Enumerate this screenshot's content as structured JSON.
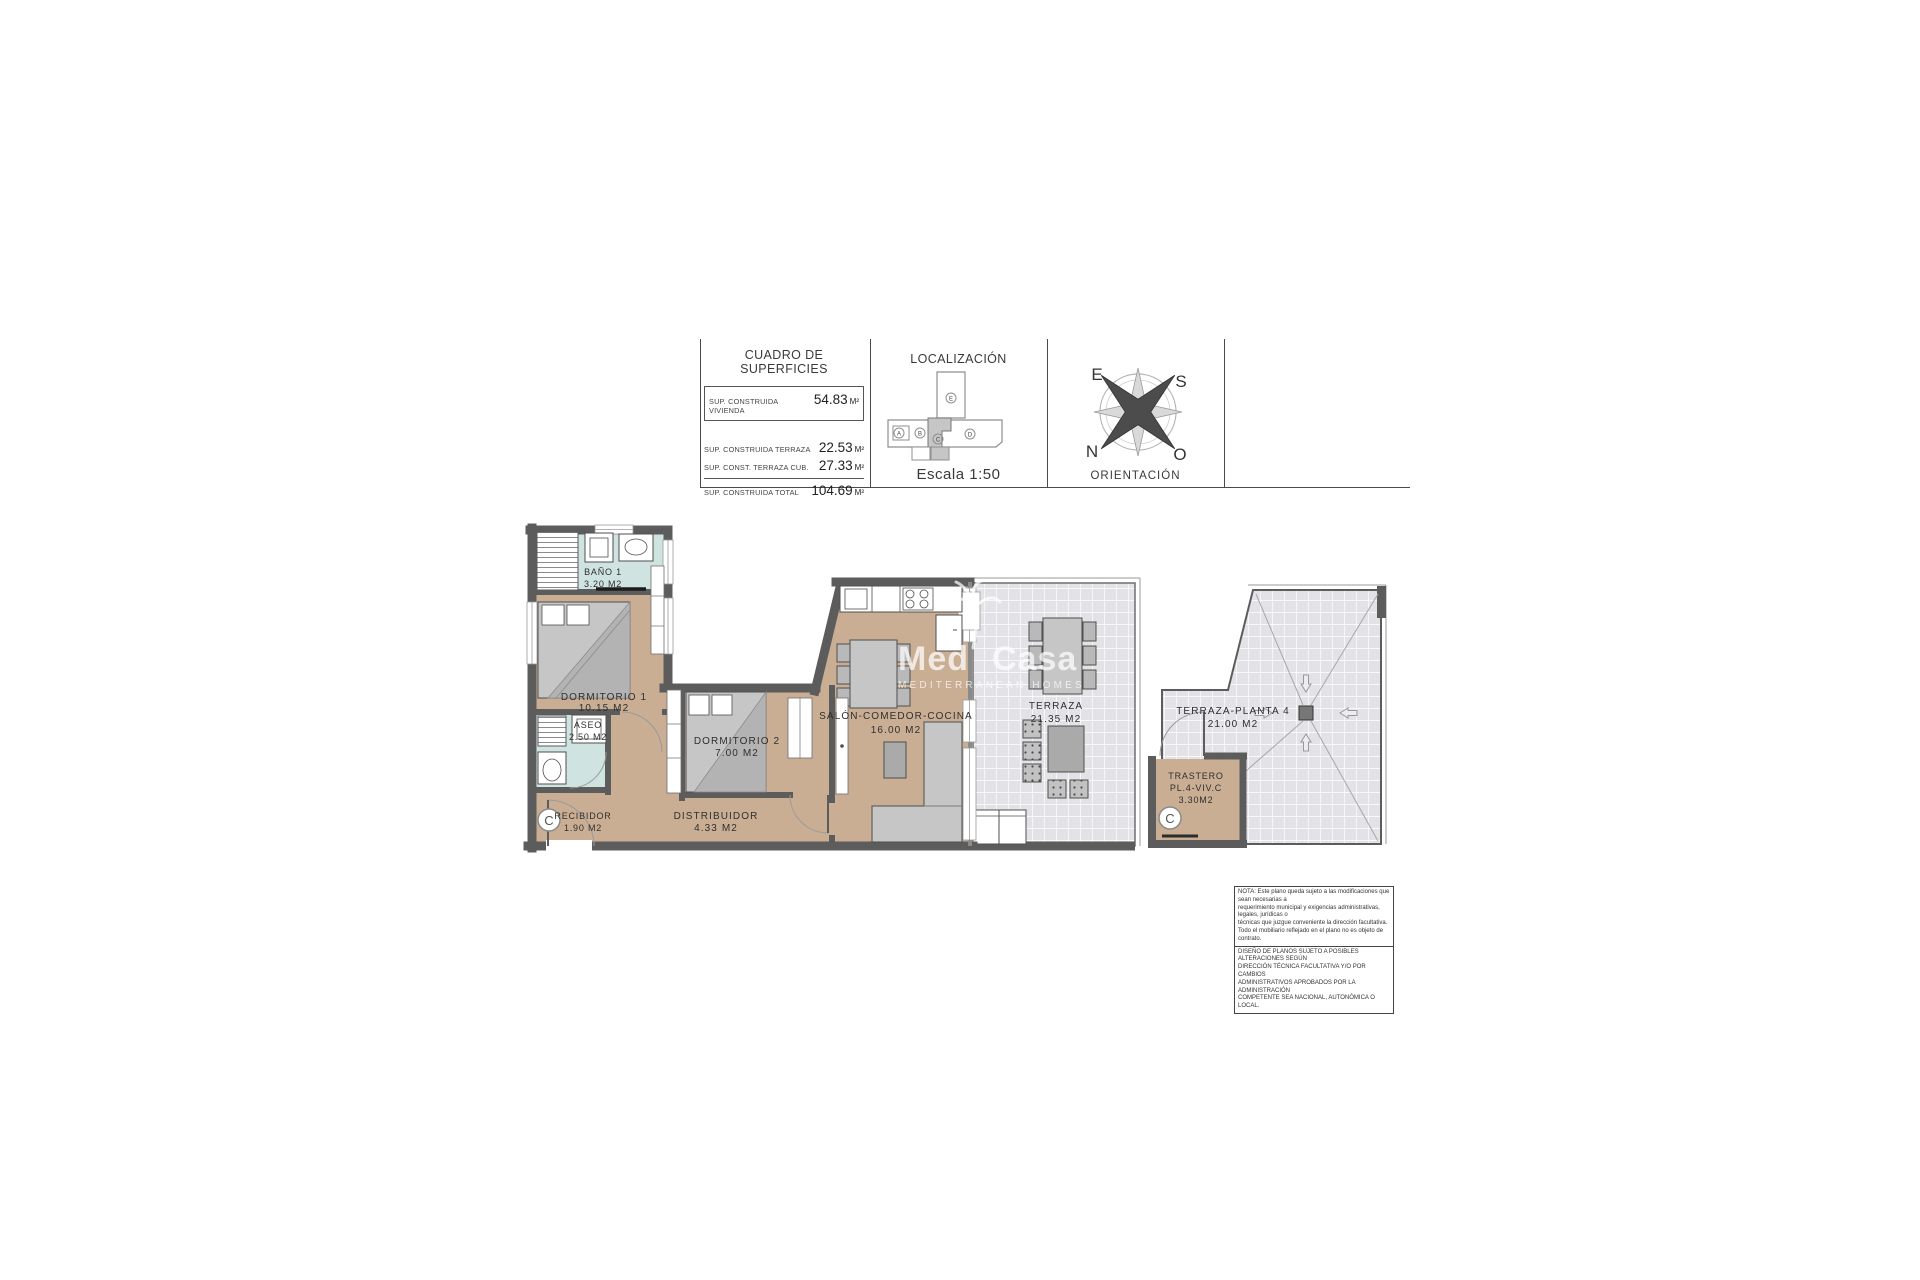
{
  "header": {
    "surface_table": {
      "title": "CUADRO DE SUPERFICIES",
      "rows": [
        {
          "label": "SUP. CONSTRUIDA VIVIENDA",
          "value": "54.83",
          "unit": "M²"
        },
        {
          "label": "SUP. CONSTRUIDA TERRAZA",
          "value": "22.53",
          "unit": "M²"
        },
        {
          "label": "SUP. CONST. TERRAZA CUB.",
          "value": "27.33",
          "unit": "M²"
        },
        {
          "label": "SUP. CONSTRUIDA TOTAL",
          "value": "104.69",
          "unit": "M²"
        }
      ]
    },
    "localizacion": {
      "title": "LOCALIZACIÓN",
      "scale_label": "Escala 1:50",
      "blocks": [
        "A",
        "B",
        "C",
        "D",
        "E"
      ],
      "highlighted_block": "C"
    },
    "orientacion": {
      "title": "ORIENTACIÓN",
      "compass": {
        "top_left": "E",
        "top_right": "S",
        "bottom_left": "N",
        "bottom_right": "O"
      }
    }
  },
  "plan": {
    "unit_letter": "C",
    "rooms": [
      {
        "name": "BAÑO 1",
        "area": "3.20 M2"
      },
      {
        "name": "DORMITORIO 1",
        "area": "10.15 M2"
      },
      {
        "name": "ASEO",
        "area": "2.50 M2"
      },
      {
        "name": "RECIBIDOR",
        "area": "1.90 M2"
      },
      {
        "name": "DISTRIBUIDOR",
        "area": "4.33 M2"
      },
      {
        "name": "DORMITORIO 2",
        "area": "7.00 M2"
      },
      {
        "name": "SALÓN-COMEDOR-COCINA",
        "area": "16.00 M2"
      },
      {
        "name": "TERRAZA",
        "area": "21.35 M2"
      },
      {
        "name": "TERRAZA-PLANTA 4",
        "area": "21.00 M2"
      },
      {
        "name": "TRASTERO",
        "sub": "PL.4-VIV.C",
        "area": "3.30M2"
      }
    ]
  },
  "watermark": {
    "word1": "Med",
    "word2": "Casa",
    "subtitle": "MEDITERRANEAN HOMES"
  },
  "notes": {
    "nota": "NOTA: Este plano queda sujeto a las modificaciones que sean necesarias a\nrequerimiento municipal y exigencias administrativas, legales, jurídicas o\ntécnicas que juzgue conveniente la dirección facultativa.\nTodo el mobiliario reflejado en el plano no es objeto de contrato.",
    "diseno": "DISEÑO DE PLANOS SUJETO A POSIBLES ALTERACIONES SEGÚN\nDIRECCIÓN TÉCNICA FACULTATIVA Y/O POR CAMBIOS\nADMINISTRATIVOS APROBADOS POR LA ADMINISTRACIÓN\nCOMPETENTE SEA NACIONAL, AUTONÓMICA O LOCAL."
  },
  "colors": {
    "wall": "#5c5c5c",
    "floor_tan": "#c9ae94",
    "floor_wet": "#cfe4e1",
    "tile": "#e3e3e7",
    "furniture": "#c6c6c6"
  }
}
